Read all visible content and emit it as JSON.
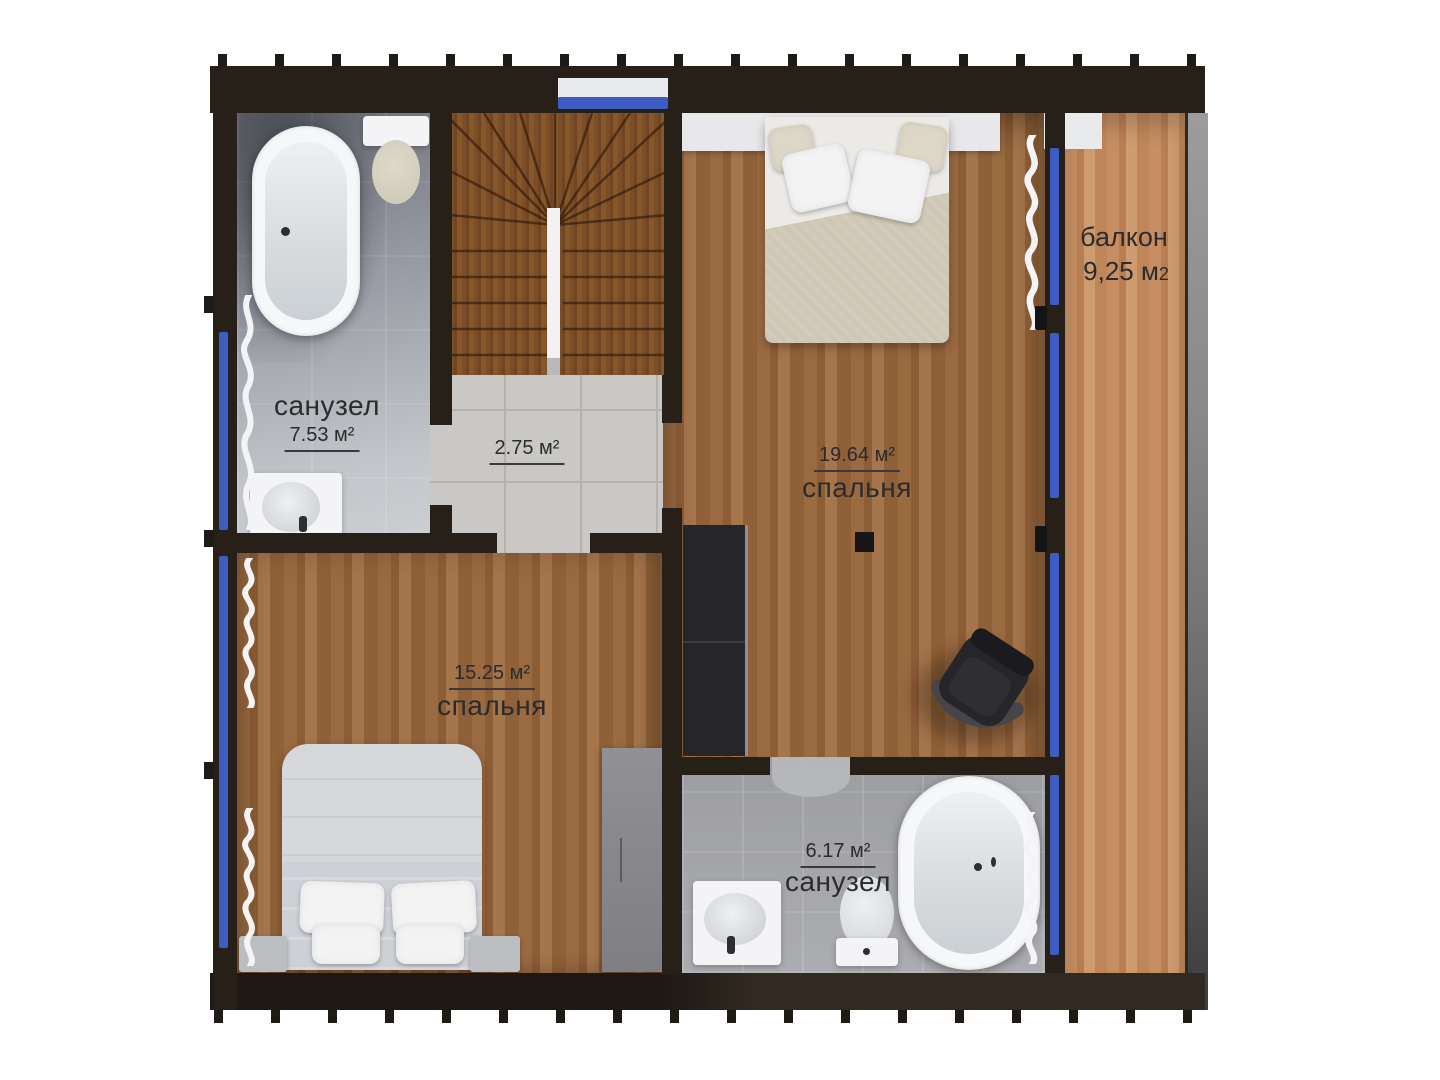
{
  "plan": {
    "floor_type": "second-floor-plan",
    "colors": {
      "wall": "#272019",
      "window_glass": "#3d5cc4",
      "wood_floor": "#9a6a41",
      "wood_balcony": "#c68e62",
      "wood_stairs": "#7c4e26",
      "tile_light": "#c9c8c4",
      "tile_gray": "#a6a7ab",
      "concrete": "#88888a",
      "label_text": "#2b2b2d"
    },
    "rooms": [
      {
        "id": "bathroom-top",
        "name": "санузел",
        "area": "7.53 м²",
        "fixtures": [
          "bathtub",
          "toilet",
          "washbasin",
          "curtain"
        ]
      },
      {
        "id": "hall-landing",
        "name": "",
        "area": "2.75 м²",
        "fixtures": [
          "staircase"
        ]
      },
      {
        "id": "bedroom-main",
        "name": "спальня",
        "area": "19.64 м²",
        "fixtures": [
          "double-bed",
          "wardrobe",
          "office-chair",
          "ceiling-light",
          "curtain"
        ]
      },
      {
        "id": "balcony",
        "name": "балкон",
        "area": "9,25 м",
        "area_sub": "2",
        "fixtures": []
      },
      {
        "id": "bedroom-second",
        "name": "спальня",
        "area": "15.25 м²",
        "fixtures": [
          "double-bed",
          "nightstand",
          "nightstand",
          "wardrobe",
          "curtain"
        ]
      },
      {
        "id": "bathroom-bottom",
        "name": "санузел",
        "area": "6.17 м²",
        "fixtures": [
          "washbasin",
          "toilet",
          "bathtub",
          "curtain",
          "door-mat"
        ]
      }
    ]
  }
}
